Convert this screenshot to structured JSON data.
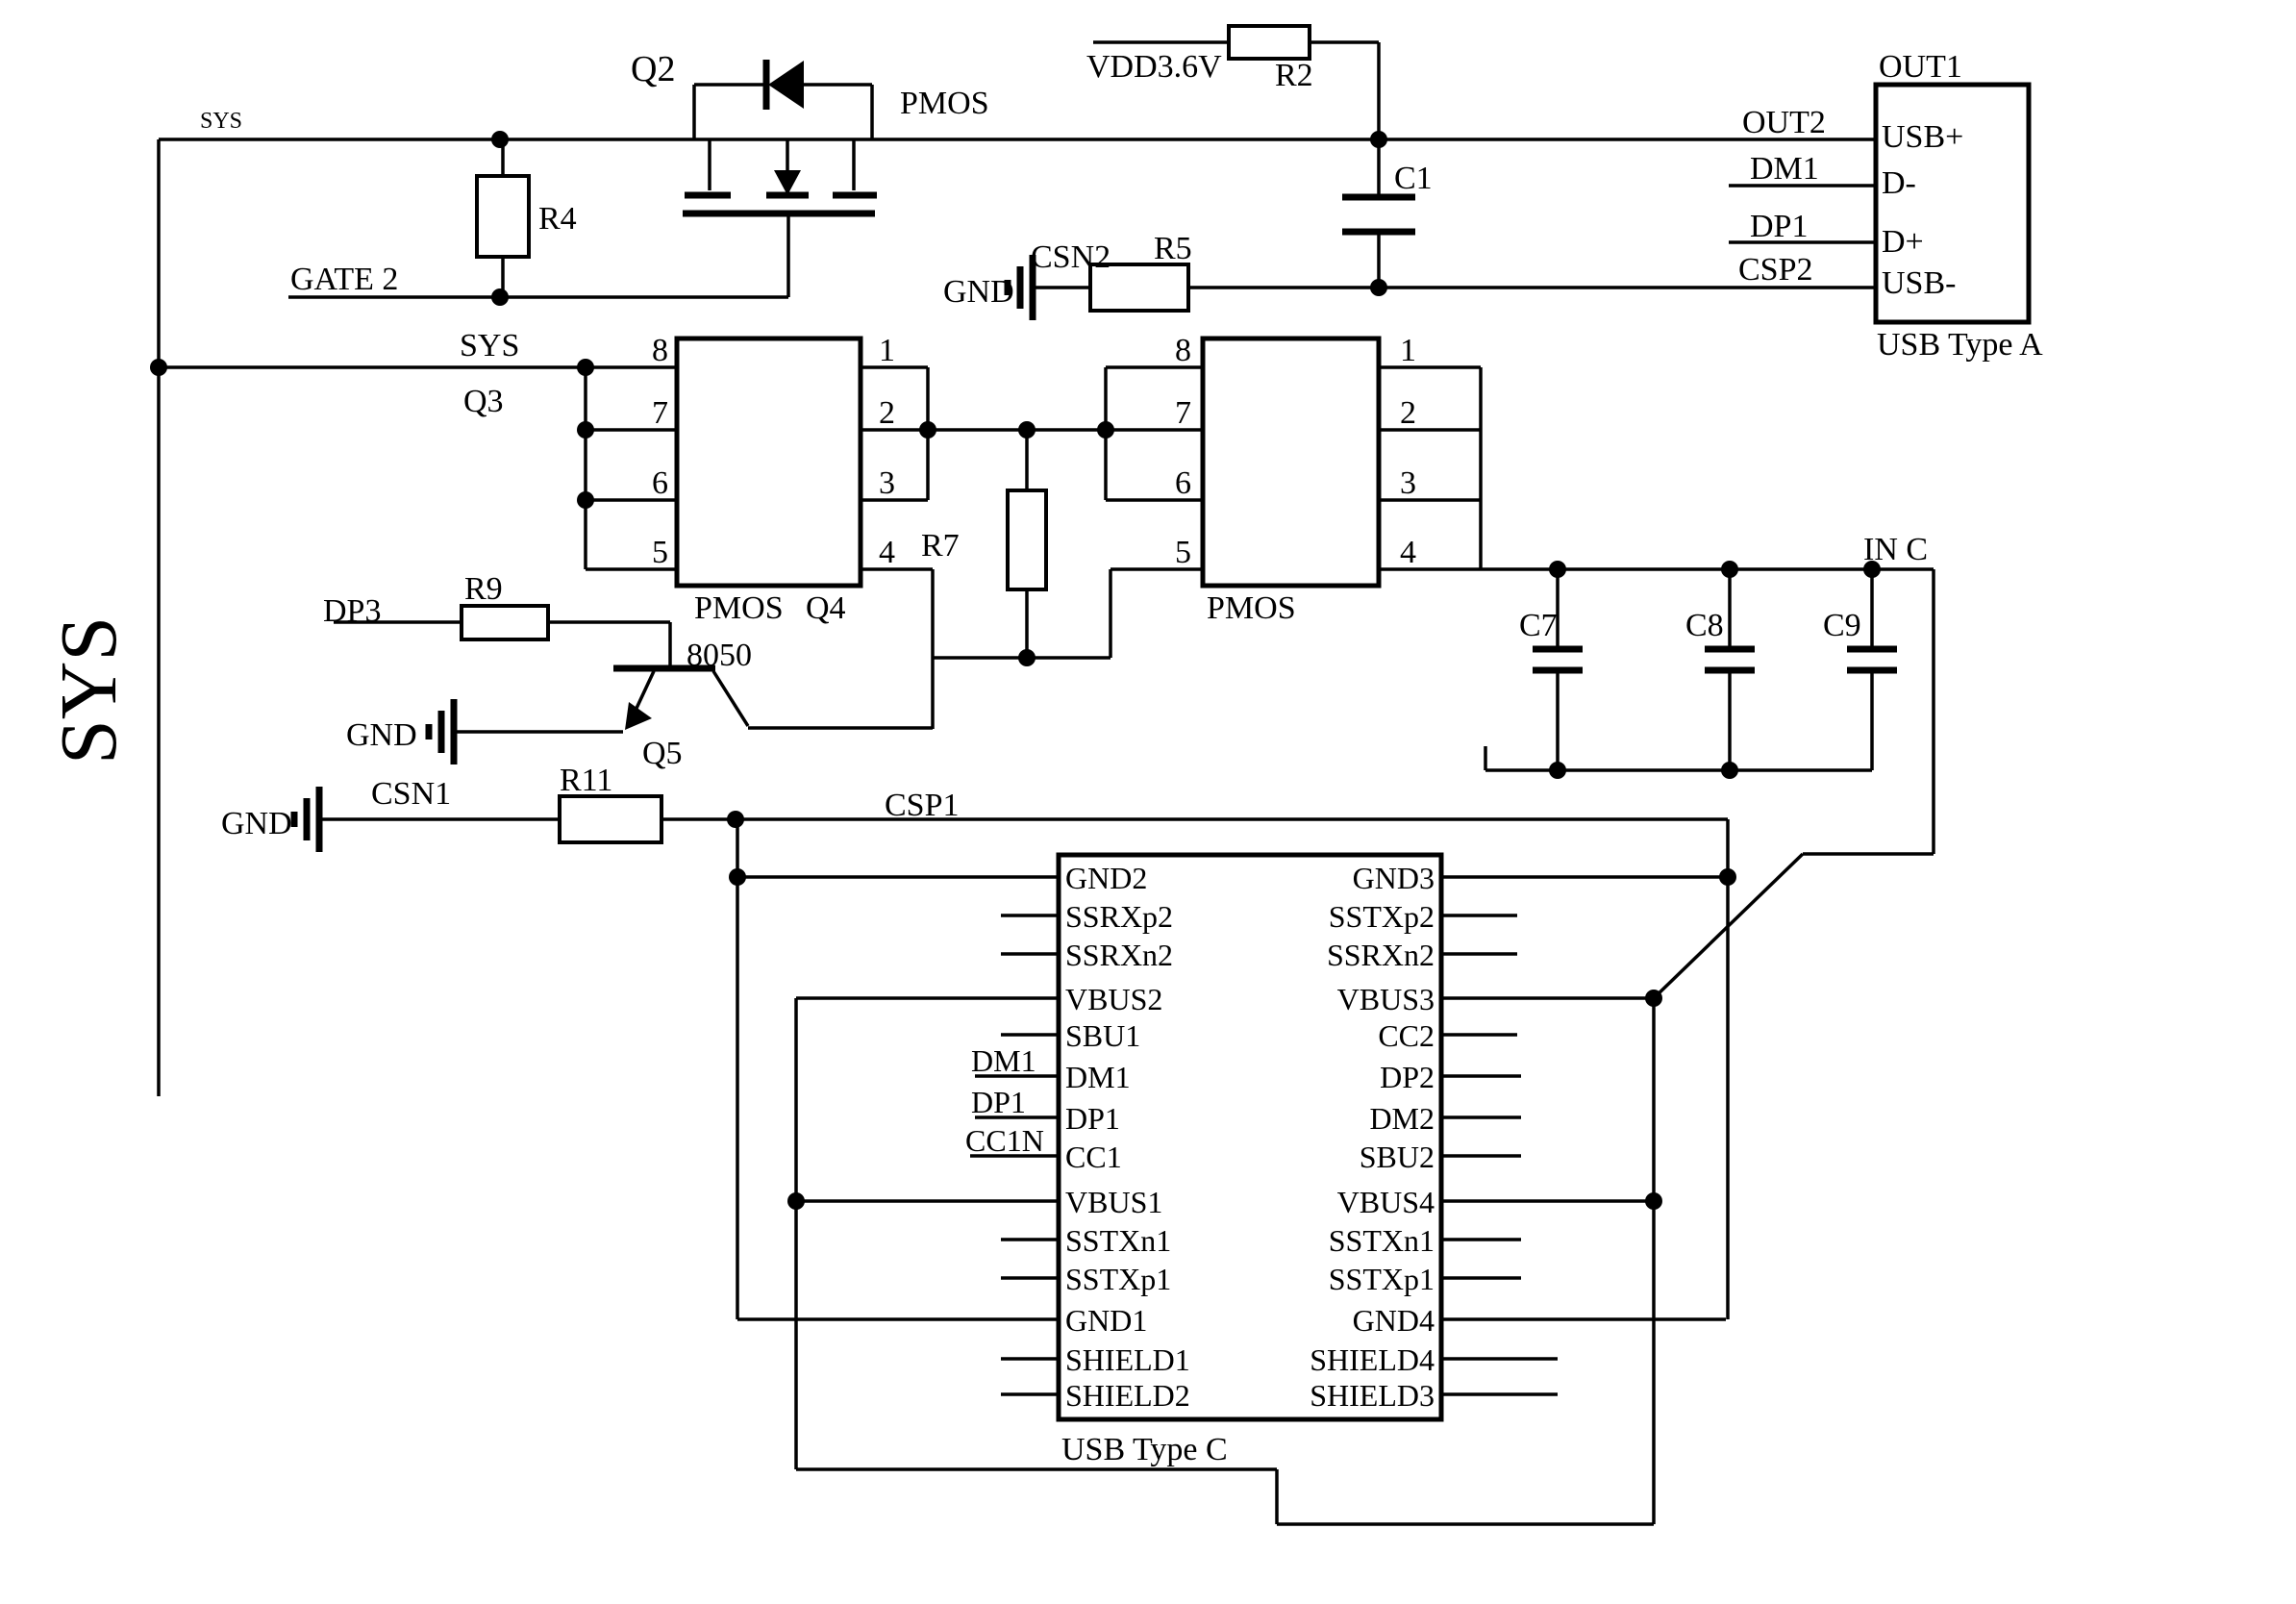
{
  "diagram_title": "USB charging port schematic",
  "colors": {
    "ink": "#000000",
    "background": "#ffffff"
  },
  "labels": {
    "sys_rail_small": "SYS",
    "sys_mid": "SYS",
    "sys_big": "SYS",
    "q2": "Q2",
    "q2_type": "PMOS",
    "vdd": "VDD3.6V",
    "r2": "R2",
    "c1": "C1",
    "out1": "OUT1",
    "out2": "OUT2",
    "dm1_net": "DM1",
    "dp1_net": "DP1",
    "csp2": "CSP2",
    "gnd_csn2": "GND",
    "csn2": "CSN2",
    "r5": "R5",
    "r4": "R4",
    "gate2": "GATE 2",
    "q3": "Q3",
    "r7": "R7",
    "dp3": "DP3",
    "r9": "R9",
    "q5_type": "8050",
    "gnd_q5": "GND",
    "q5": "Q5",
    "gnd_csn1": "GND",
    "csn1": "CSN1",
    "r11": "R11",
    "csp1": "CSP1",
    "c7": "C7",
    "c8": "C8",
    "c9": "C9",
    "in_c": "IN C"
  },
  "usb_a": {
    "title": "USB Type A",
    "pins": [
      "USB+",
      "D-",
      "D+",
      "USB-"
    ]
  },
  "ic1": {
    "type": "PMOS",
    "ref": "Q4",
    "left_pins": [
      "8",
      "7",
      "6",
      "5"
    ],
    "right_pins": [
      "1",
      "2",
      "3",
      "4"
    ]
  },
  "ic2": {
    "type": "PMOS",
    "left_pins": [
      "8",
      "7",
      "6",
      "5"
    ],
    "right_pins": [
      "1",
      "2",
      "3",
      "4"
    ]
  },
  "usb_c": {
    "title": "USB Type C",
    "left_pins": [
      "GND2",
      "SSRXp2",
      "SSRXn2",
      "VBUS2",
      "SBU1",
      "DM1",
      "DP1",
      "CC1",
      "VBUS1",
      "SSTXn1",
      "SSTXp1",
      "GND1",
      "SHIELD1",
      "SHIELD2"
    ],
    "right_pins": [
      "GND3",
      "SSTXp2",
      "SSRXn2",
      "VBUS3",
      "CC2",
      "DP2",
      "DM2",
      "SBU2",
      "VBUS4",
      "SSTXn1",
      "SSTXp1",
      "GND4",
      "SHIELD4",
      "SHIELD3"
    ],
    "external_labels": [
      "DM1",
      "DP1",
      "CC1N"
    ]
  }
}
